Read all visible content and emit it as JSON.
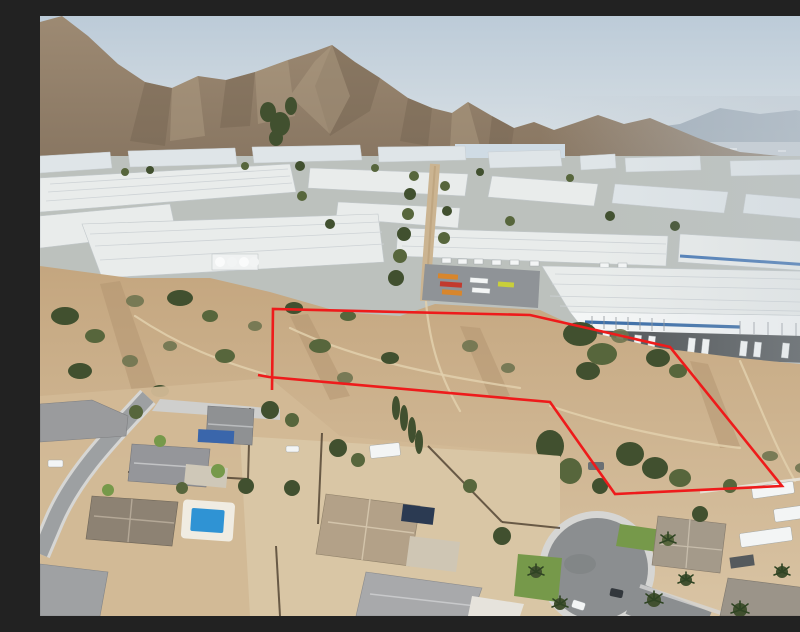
{
  "image": {
    "description": "Aerial drone photo of a vacant hillside land parcel outlined in red, between an industrial warehouse park below desert mountains and a residential neighborhood with a cul-de-sac in the foreground"
  },
  "outline": {
    "color": "#ee1b1b",
    "stroke_width": "2.6",
    "points": "232,374 233,293 490,299 630,331 742,470 575,478 510,386 229,361 218,359"
  },
  "palette": {
    "sky_top": "#bccbd8",
    "sky_horizon": "#e1e6e8",
    "mountain": "#94805a",
    "mountain_shadow": "#72624f",
    "haze_hills": "#8f9dab",
    "warehouse_roof": "#e9eceb",
    "asphalt_dark": "#54585a",
    "road_grey": "#9da0a2",
    "scrub_tan": "#c9ac87",
    "dirt_light": "#d8c2a2",
    "tree_green": "#41502f",
    "pool_blue": "#2f93d4",
    "pool_cover_blue": "#3a66ab",
    "lawn_green": "#76994a"
  },
  "scene": {
    "background": [
      "sky",
      "hazy-distant-hills",
      "desert-mountain-range"
    ],
    "midground": [
      "industrial-warehouse-park",
      "truck-docks",
      "dirt-road"
    ],
    "foreground": [
      "outlined-vacant-parcel",
      "scrub-hillside",
      "residential-neighborhood",
      "cul-de-sac",
      "swimming-pool",
      "rv-trailers"
    ]
  }
}
